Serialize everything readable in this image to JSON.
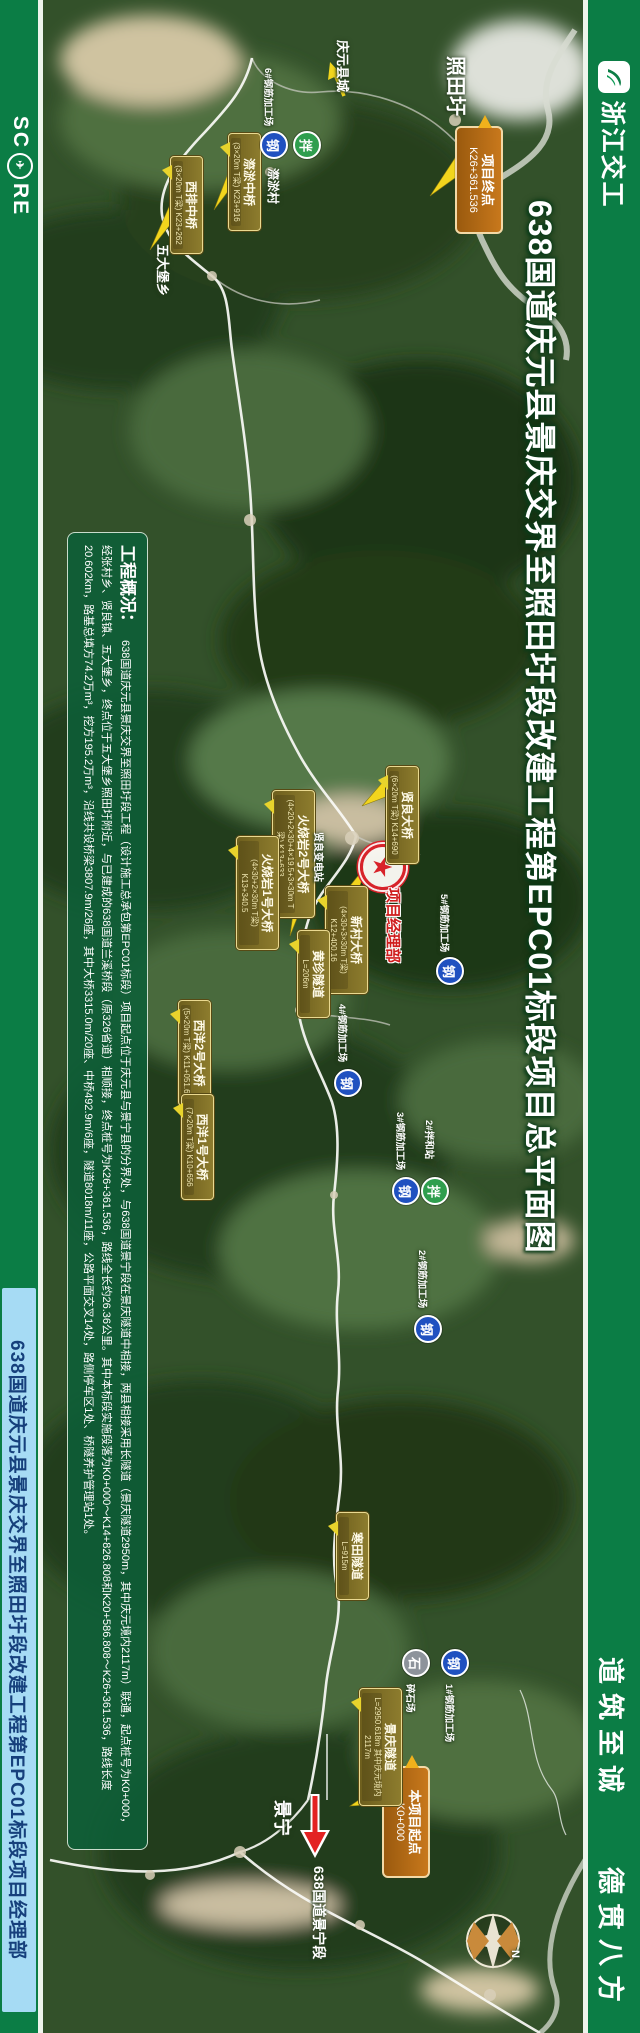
{
  "colors": {
    "band_green": "#0b7d45",
    "strip_blue": "#a6dbf4",
    "label_olive": "#7c6c22",
    "marker_orange": "#b96c14",
    "badge_blue": "#2051c0",
    "badge_green": "#2f9e4e",
    "badge_grey": "#8d939b",
    "star_red": "#d8232a"
  },
  "right_banner": {
    "logo_text": "浙江交工",
    "slogan_top": "道筑至诚",
    "slogan_bottom": "德贯八方"
  },
  "left_banner": {
    "logo_pre": "SC",
    "logo_post": "RE",
    "globe_icon": "✈",
    "dept": "638国道庆元县景庆交界至照田圩段改建工程第EPC01标段项目经理部"
  },
  "map_title": "638国道庆元县景庆交界至照田圩段改建工程第EPC01标段项目总平面图",
  "overview": {
    "title": "工程概况：",
    "body": "638国道庆元县景庆交界至照田圩段工程（设计施工总承包第EPC01标段）项目起点位于庆元县与景宁县的分界处，与638国道景宁段在景庆隧道中相接，两县相接采用长隧道（景庆隧道2950m，其中庆元境内2117m）联通，起点桩号为K0+000，经张村乡、贤良镇、五大堡乡，终点位于五大堡乡照田圩附近，与已建成的638国道兰溪桥段（原326省道）相顺接，终点桩号为K26+361.536，路线全长约26.36公里。其中本标段实施段落为K0+000～K14+826.808和K20+586.808～K26+361.536，路线长度20.602km，路基总填方74.2万m³，挖方195.2万m³，沿线共设桥梁3807.9m/26座，其中大桥3315.0m/20座、中桥492.9m/6座，隧道8018m/11座，公路平面交叉14处，路侧停车区1处、桥隧养护管理站1处。"
  },
  "markers": {
    "endpoint": {
      "label": "项目终点",
      "sub": "K26+361.536"
    },
    "startpoint": {
      "label": "本项目起点",
      "sub": "K0+000"
    },
    "hq": {
      "star": "★",
      "label": "项目经理部"
    }
  },
  "labels": [
    {
      "name": "西排中桥",
      "sub": "(3×20m T梁) K23+262",
      "x": 170,
      "y": 156,
      "w": 88
    },
    {
      "name": "漈淤中桥",
      "sub": "(3×20m T梁) K23+916",
      "x": 228,
      "y": 133,
      "w": 88
    },
    {
      "name": "贤良大桥",
      "sub": "(6×20m T梁) K14+690",
      "x": 386,
      "y": 766,
      "w": 88
    },
    {
      "name": "火烧岩2号大桥",
      "sub": "(4×20+2×30+4×19.5+3×30m T梁) K13+633",
      "x": 272,
      "y": 790,
      "w": 118
    },
    {
      "name": "火烧岩1号大桥",
      "sub": "(4×30+2×30m T梁) K13+340.5",
      "x": 236,
      "y": 836,
      "w": 104
    },
    {
      "name": "新村大桥",
      "sub": "(4×30+3×30m T梁) K12+400.16",
      "x": 325,
      "y": 886,
      "w": 98
    },
    {
      "name": "黄珍隧道",
      "sub": "L=206m",
      "x": 297,
      "y": 930,
      "w": 78
    },
    {
      "name": "西洋2号大桥",
      "sub": "(5×20m T梁) K11+051.66",
      "x": 178,
      "y": 1000,
      "w": 96
    },
    {
      "name": "西洋1号大桥",
      "sub": "(7×20m T梁) K10+656",
      "x": 181,
      "y": 1094,
      "w": 96
    },
    {
      "name": "寒田隧道",
      "sub": "L=915m",
      "x": 336,
      "y": 1512,
      "w": 78
    },
    {
      "name": "景庆隧道",
      "sub": "L=2950.618m 其中庆元境内2117m",
      "x": 359,
      "y": 1688,
      "w": 108
    }
  ],
  "badges": [
    {
      "char": "钢",
      "color": "blue",
      "x": 260,
      "y": 131,
      "label": "6#钢筋加工场",
      "lx": 264,
      "ly": 68
    },
    {
      "char": "拌",
      "color": "green",
      "x": 293,
      "y": 131,
      "label": "",
      "lx": 0,
      "ly": 0
    },
    {
      "char": "钢",
      "color": "blue",
      "x": 436,
      "y": 957,
      "label": "5#钢筋加工场",
      "lx": 440,
      "ly": 894
    },
    {
      "char": "钢",
      "color": "blue",
      "x": 334,
      "y": 1069,
      "label": "4#钢筋加工场",
      "lx": 338,
      "ly": 1004
    },
    {
      "char": "钢",
      "color": "blue",
      "x": 392,
      "y": 1177,
      "label": "3#钢筋加工场",
      "lx": 396,
      "ly": 1112
    },
    {
      "char": "拌",
      "color": "green",
      "x": 421,
      "y": 1177,
      "label": "2#拌和站",
      "lx": 425,
      "ly": 1120
    },
    {
      "char": "钢",
      "color": "blue",
      "x": 414,
      "y": 1315,
      "label": "2#钢筋加工场",
      "lx": 418,
      "ly": 1250
    },
    {
      "char": "石",
      "color": "grey",
      "x": 402,
      "y": 1649,
      "label": "碎石场",
      "lx": 406,
      "ly": 1684
    },
    {
      "char": "钢",
      "color": "blue",
      "x": 441,
      "y": 1649,
      "label": "1#钢筋加工场",
      "lx": 445,
      "ly": 1684
    }
  ],
  "place_texts": [
    {
      "text": "照田圩",
      "x": 448,
      "y": 56,
      "fs": 20
    },
    {
      "text": "庆元县城",
      "x": 336,
      "y": 40,
      "fs": 13
    },
    {
      "text": "五大堡乡",
      "x": 156,
      "y": 244,
      "fs": 13
    },
    {
      "text": "漈淤村",
      "x": 266,
      "y": 168,
      "fs": 12
    },
    {
      "text": "贤良变电站",
      "x": 313,
      "y": 832,
      "fs": 10
    },
    {
      "text": "景宁",
      "x": 274,
      "y": 1800,
      "fs": 18
    },
    {
      "text": "638国道景宁段",
      "x": 311,
      "y": 1866,
      "fs": 14
    },
    {
      "text": "N",
      "x": 506,
      "y": 1950,
      "fs": 11
    }
  ]
}
